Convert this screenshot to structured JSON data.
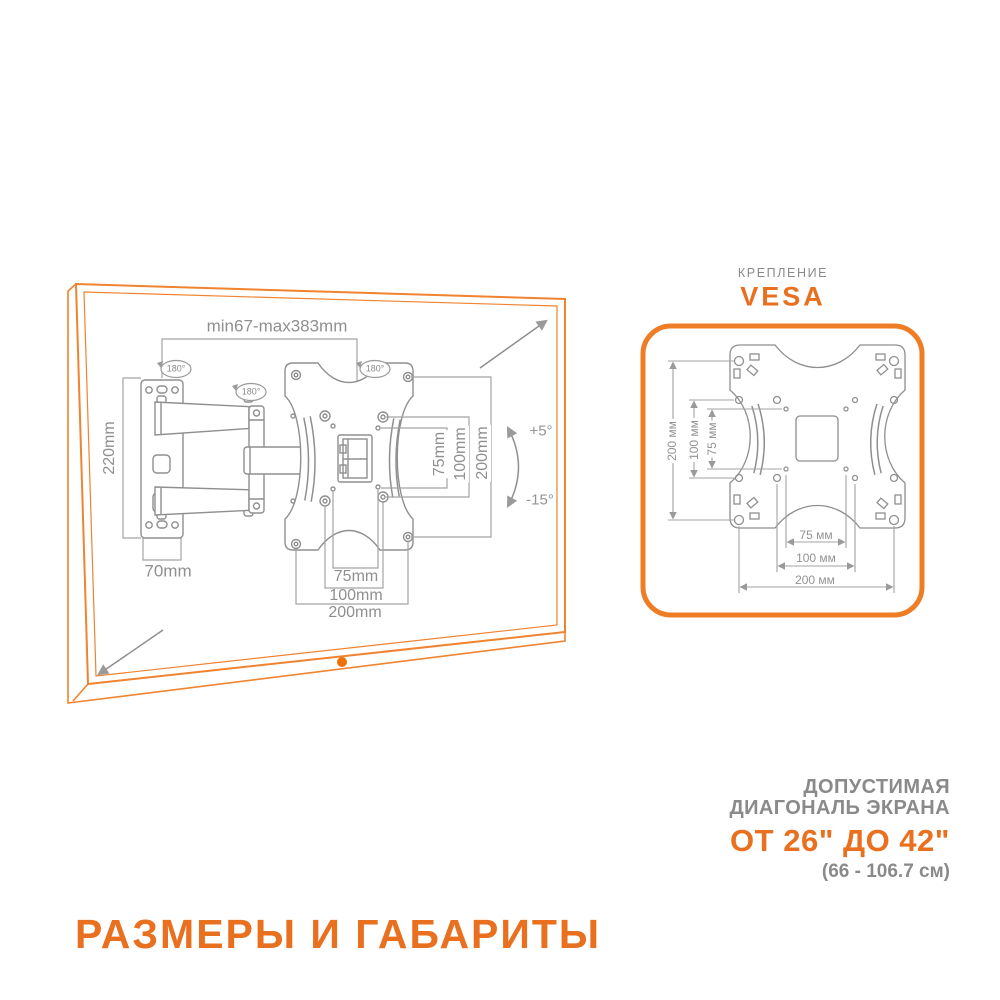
{
  "colors": {
    "accent": "#E8701F",
    "tv_outline": "#F0832F",
    "power_dot": "#EE7105",
    "vesa_border": "#EF7D26",
    "drawing_gray": "#8F8F8F",
    "text_gray": "#8A8A8A"
  },
  "main_diagram": {
    "extension_range": "min67-max383mm",
    "rotation_badges": [
      "180°",
      "180°",
      "180°"
    ],
    "wall_plate_height": "220mm",
    "wall_depth": "70mm",
    "tilt_up": "+5°",
    "tilt_down": "-15°",
    "side_dims": [
      "75mm",
      "100mm",
      "200mm"
    ],
    "bottom_dims": [
      "75mm",
      "100mm",
      "200mm"
    ]
  },
  "vesa_panel": {
    "kicker": "КРЕПЛЕНИЕ",
    "title": "VESA",
    "left_dims": [
      "200 мм",
      "100 мм",
      "75 мм"
    ],
    "bottom_dims": [
      "75 мм",
      "100 мм",
      "200 мм"
    ]
  },
  "diagonal_info": {
    "line1": "ДОПУСТИМАЯ",
    "line2": "ДИАГОНАЛЬ ЭКРАНА",
    "range_inches": "ОТ 26\" ДО 42\"",
    "range_cm": "(66 - 106.7 см)"
  },
  "footer_title": "РАЗМЕРЫ И ГАБАРИТЫ"
}
